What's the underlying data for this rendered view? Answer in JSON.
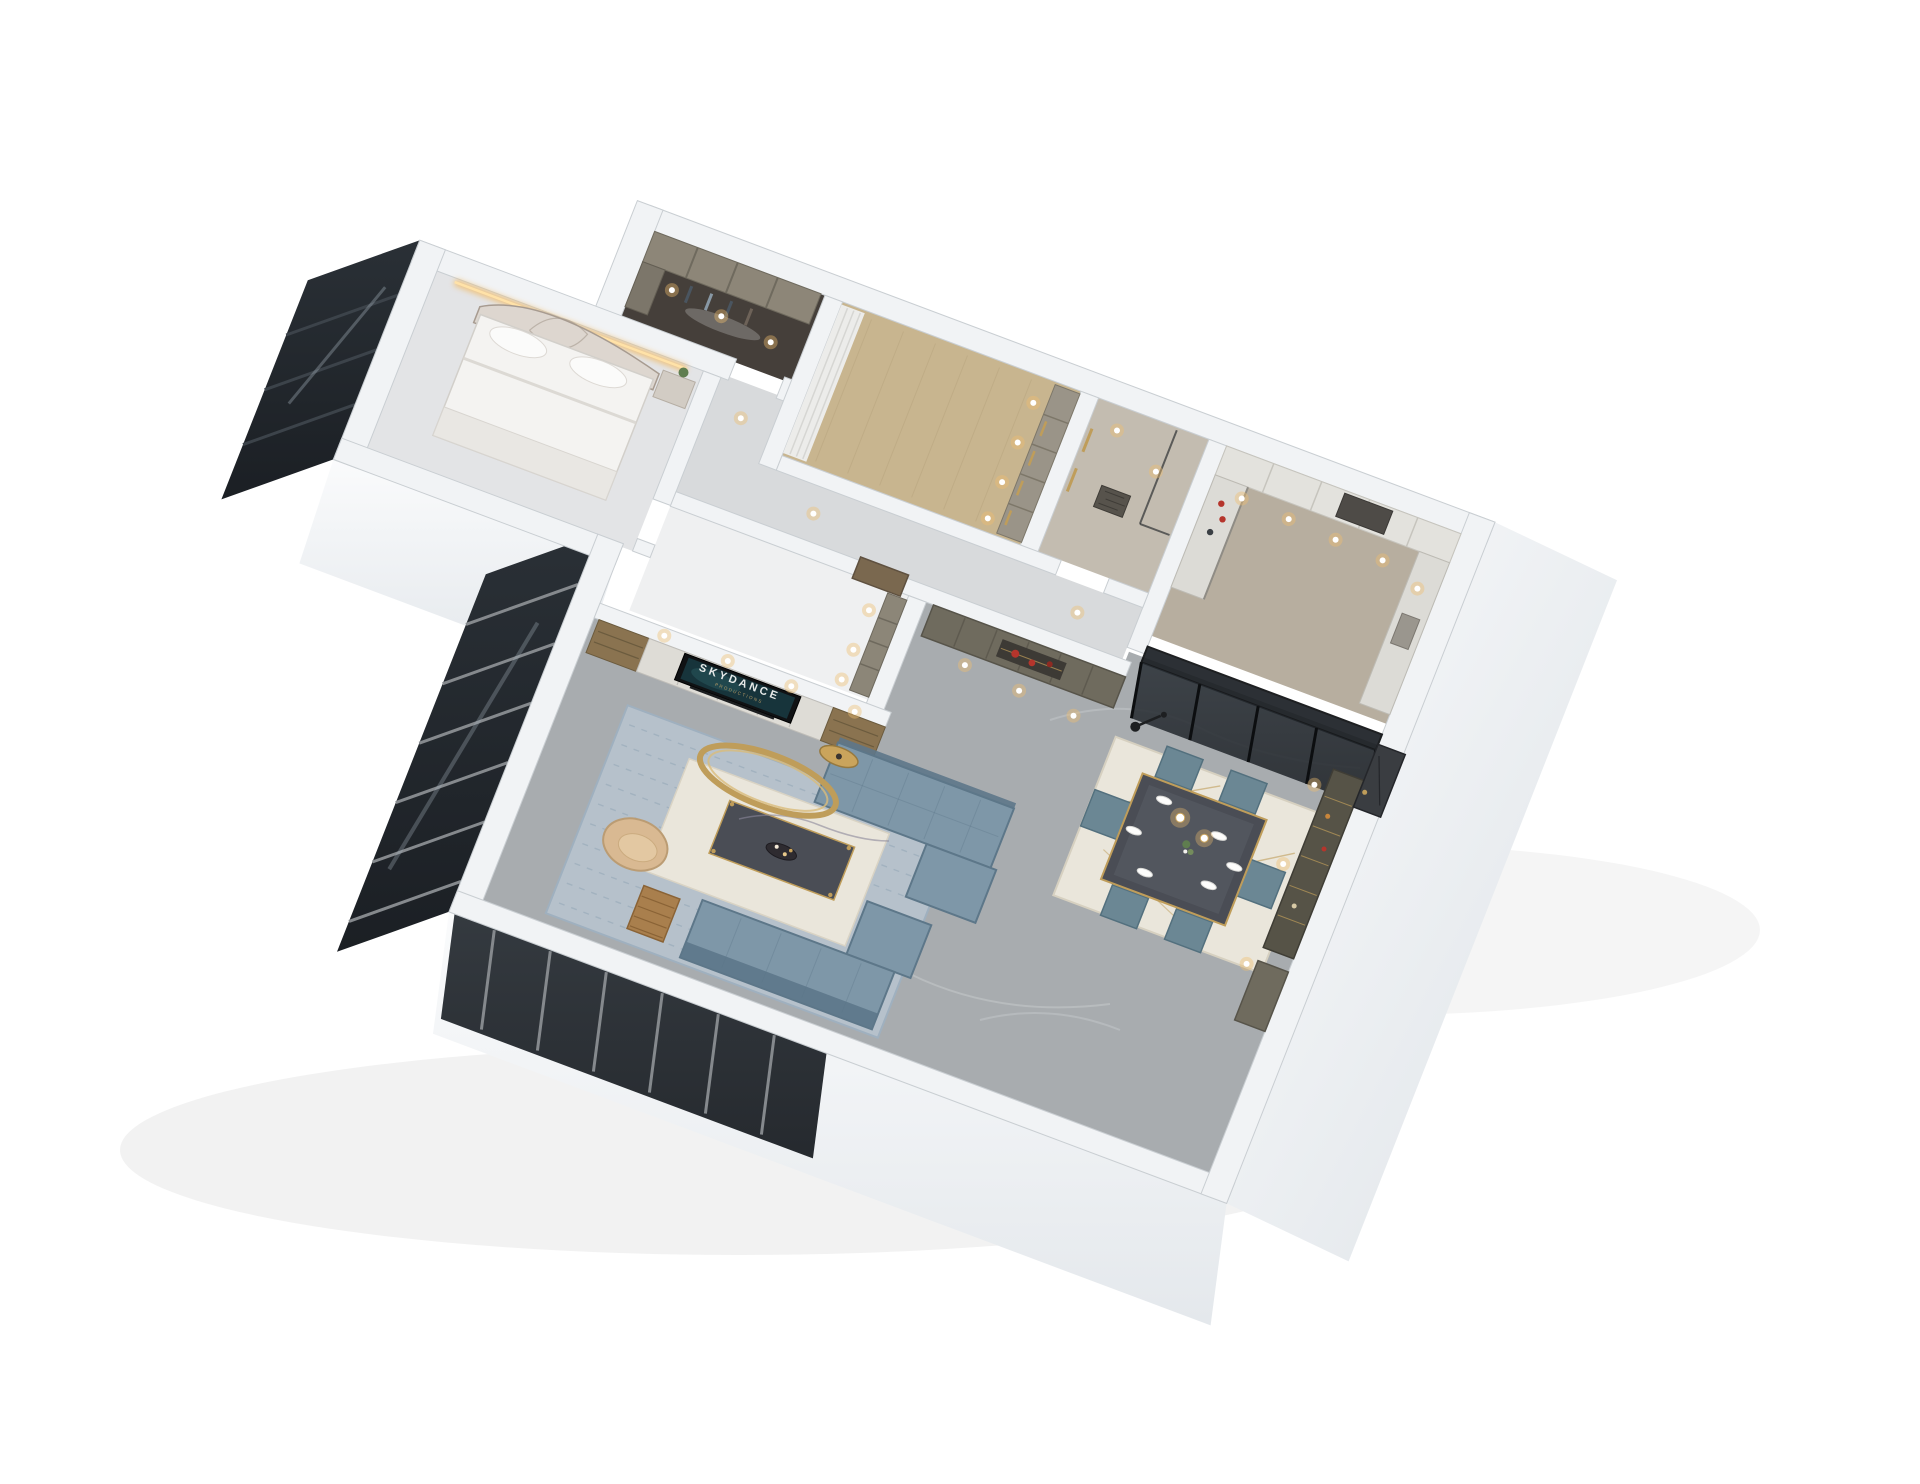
{
  "tv_screen": {
    "title": "SKYDANCE",
    "subtitle": "PRODUCTIONS"
  },
  "palette": {
    "background": "#ffffff",
    "wallTop": "#f1f3f5",
    "wallEdge": "#c9ced2",
    "wallFaceLight": "#fafbfc",
    "wallFaceShade": "#dde2e7",
    "glassDark": "#1b1f24",
    "glassFrame": "#85898d",
    "glassStreak": "#a9b6c0",
    "floorMarble": "#a8acaf",
    "marbleVein": "#c7cbce",
    "floorWood": "#c8b58f",
    "floorBath": "#c3bcb0",
    "floorKitchen": "#b7ae9f",
    "floorCloset": "#453f3a",
    "floorStudy": "#eff0f1",
    "floorBedroom": "#e3e4e6",
    "floorHall": "#d8dadc",
    "cabinetOlive": "#6f6b5e",
    "cabinetOliveDark": "#57544a",
    "cabinetLight": "#dedcd6",
    "woodShelf": "#8a7350",
    "woodDark": "#6b5b3e",
    "sofaBlue": "#7e97a8",
    "sofaBlueDark": "#5d7789",
    "rugBlue": "#b6c1cb",
    "rugPattern": "#93a6b6",
    "rugCream": "#eae6db",
    "tableDark": "#4a4d55",
    "gold": "#bf9d5a",
    "warmLight": "#f0bd6e",
    "tanChair": "#d9b992",
    "accentRed": "#b5352c",
    "tvBlack": "#101214",
    "tvScreen": "#17343b",
    "tvText": "#e6e9e8",
    "doorWood": "#7a684f",
    "doorDark": "#3a3d41",
    "plantGreen": "#5f7d4f"
  }
}
